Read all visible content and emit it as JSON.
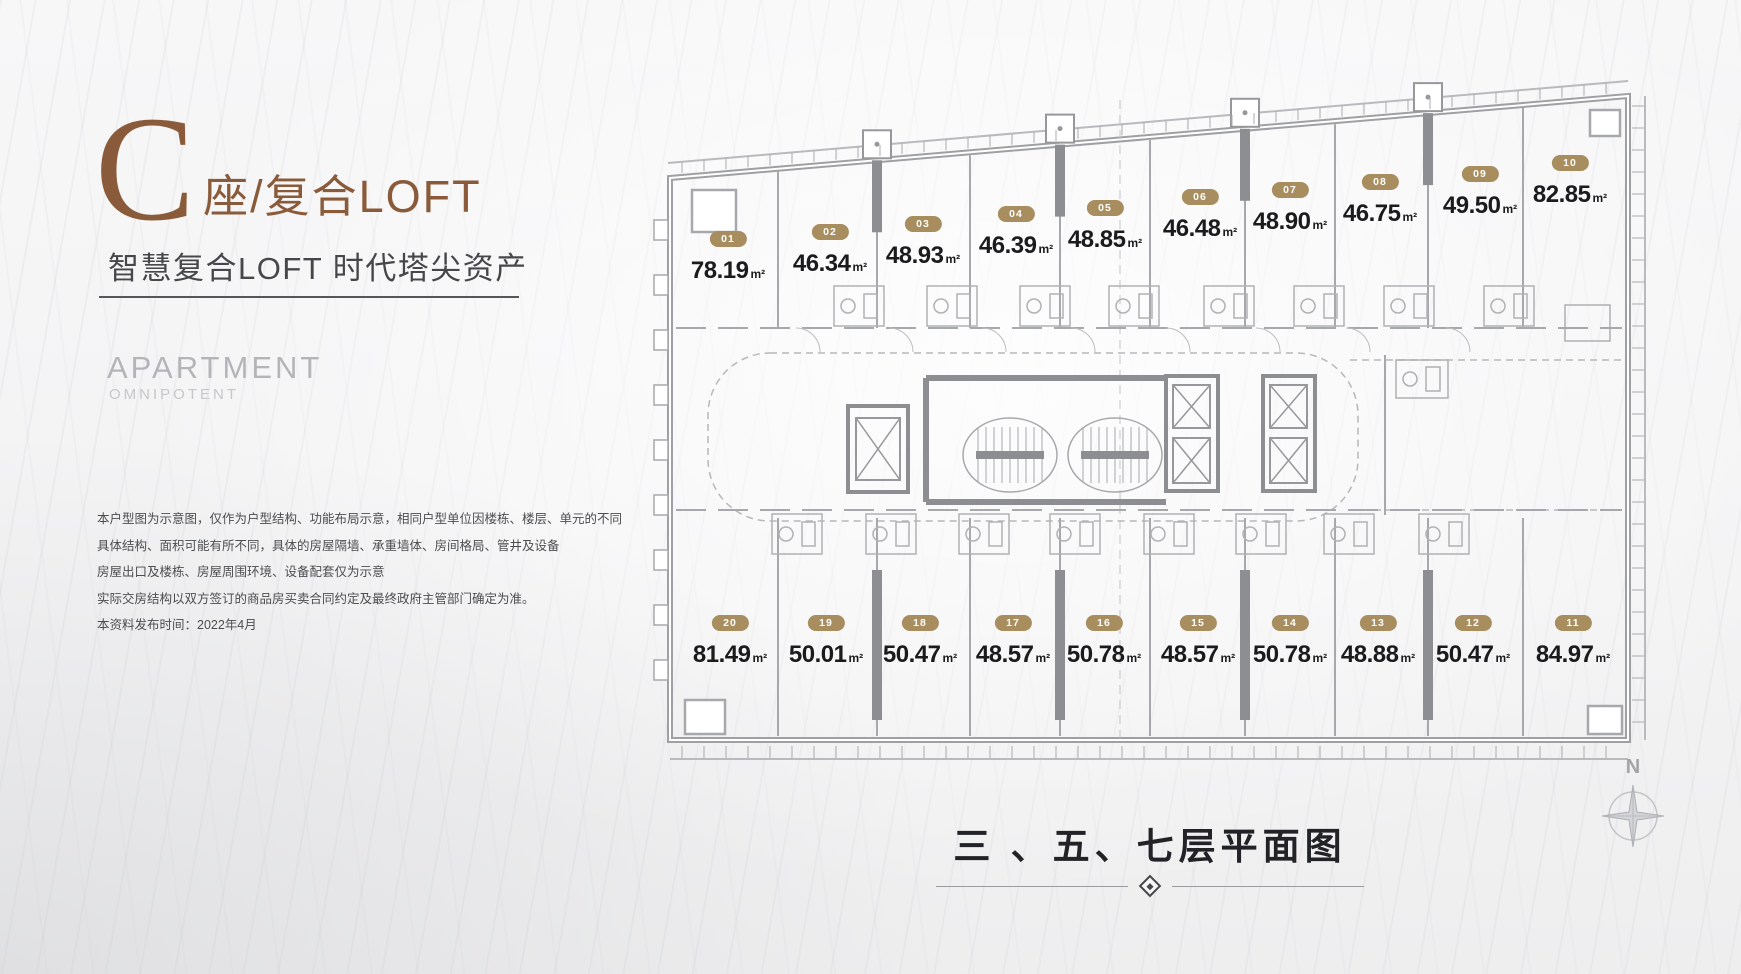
{
  "colors": {
    "brand_brown": "#8a5b3a",
    "badge_tan": "#a88d5e",
    "plan_line_gray": "#9fa0a4"
  },
  "brand": {
    "letter": "C",
    "rest": "座/复合LOFT",
    "subtitle": "智慧复合LOFT 时代塔尖资产",
    "english_title": "APARTMENT",
    "english_subtitle": "OMNIPOTENT"
  },
  "disclaimer": {
    "lines": [
      "本户型图为示意图，仅作为户型结构、功能布局示意，相同户型单位因楼栋、楼层、单元的不同",
      "具体结构、面积可能有所不同，具体的房屋隔墙、承重墙体、房间格局、管井及设备",
      "房屋出口及楼栋、房屋周围环境、设备配套仅为示意",
      "实际交房结构以双方签订的商品房买卖合同约定及最终政府主管部门确定为准。",
      "本资料发布时间：2022年4月"
    ]
  },
  "plan": {
    "area_unit": "m²",
    "top_units": [
      {
        "id": "01",
        "area": "78.19"
      },
      {
        "id": "02",
        "area": "46.34"
      },
      {
        "id": "03",
        "area": "48.93"
      },
      {
        "id": "04",
        "area": "46.39"
      },
      {
        "id": "05",
        "area": "48.85"
      },
      {
        "id": "06",
        "area": "46.48"
      },
      {
        "id": "07",
        "area": "48.90"
      },
      {
        "id": "08",
        "area": "46.75"
      },
      {
        "id": "09",
        "area": "49.50"
      },
      {
        "id": "10",
        "area": "82.85"
      }
    ],
    "bottom_units": [
      {
        "id": "20",
        "area": "81.49"
      },
      {
        "id": "19",
        "area": "50.01"
      },
      {
        "id": "18",
        "area": "50.47"
      },
      {
        "id": "17",
        "area": "48.57"
      },
      {
        "id": "16",
        "area": "50.78"
      },
      {
        "id": "15",
        "area": "48.57"
      },
      {
        "id": "14",
        "area": "50.78"
      },
      {
        "id": "13",
        "area": "48.88"
      },
      {
        "id": "12",
        "area": "50.47"
      },
      {
        "id": "11",
        "area": "84.97"
      }
    ]
  },
  "caption": {
    "title": "三 、五、七层平面图"
  },
  "compass": {
    "label": "N"
  }
}
